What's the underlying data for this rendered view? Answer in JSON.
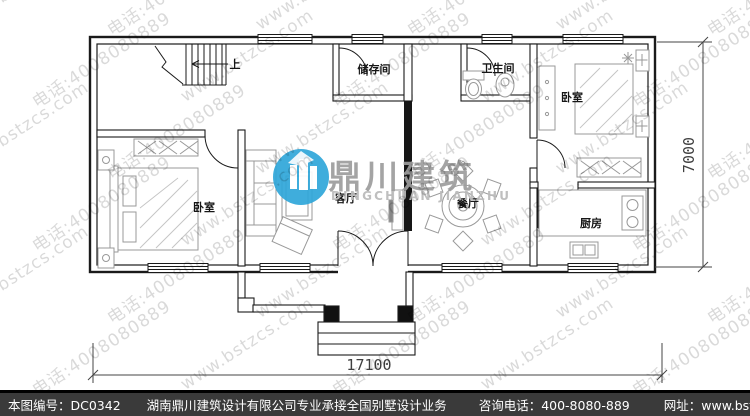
{
  "plan": {
    "rooms": [
      {
        "id": "storage",
        "label": "储存间"
      },
      {
        "id": "bathroom",
        "label": "卫生间"
      },
      {
        "id": "bedroom-right",
        "label": "卧室"
      },
      {
        "id": "bedroom-left",
        "label": "卧室"
      },
      {
        "id": "living-room",
        "label": "客厅"
      },
      {
        "id": "dining-room",
        "label": "餐厅"
      },
      {
        "id": "kitchen",
        "label": "厨房"
      }
    ],
    "stairs_label": "上",
    "dimensions": {
      "width_mm": "17100",
      "height_mm": "7000"
    },
    "line_color": "#1a1a1a",
    "furniture_color": "#999999"
  },
  "logo": {
    "cn": "鼎川建筑",
    "en": "DINGCHUAN JIANZHU",
    "accent": "#2fa7da",
    "cn_color": "#9d9d9d",
    "en_color": "#bababa"
  },
  "watermark": {
    "site_text": "www.bstzcs.com",
    "phone_text": "电话:4008080889",
    "color": "rgba(0,0,0,0.15)"
  },
  "footer": {
    "drawing_no": "本图编号：DC0342",
    "company": "湖南鼎川建筑设计有限公司专业承接全国别墅设计业务",
    "phone": "咨询电话：400-8080-889",
    "website": "网址：www.bstzcs.com",
    "bg": "#3a3a3a",
    "text_color": "#ffffff"
  }
}
